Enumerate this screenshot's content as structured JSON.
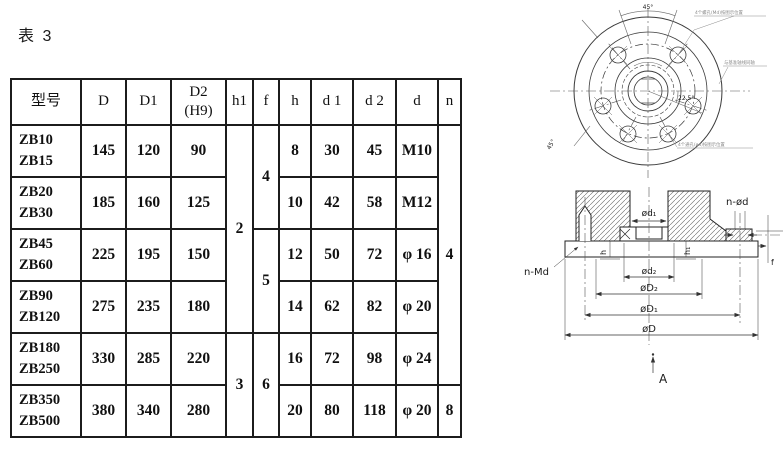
{
  "title": "表 3",
  "table": {
    "headers": {
      "model": "型号",
      "D": "D",
      "D1": "D1",
      "D2": "D2\n(H9)",
      "h1": "h1",
      "f": "f",
      "h": "h",
      "d1": "d 1",
      "d2": "d 2",
      "d": "d",
      "n": "n"
    },
    "rows": [
      {
        "model": "ZB10\nZB15",
        "D": "145",
        "D1": "120",
        "D2": "90",
        "h": "8",
        "d1": "30",
        "d2": "45",
        "d": "M10"
      },
      {
        "model": "ZB20\nZB30",
        "D": "185",
        "D1": "160",
        "D2": "125",
        "h": "10",
        "d1": "42",
        "d2": "58",
        "d": "M12"
      },
      {
        "model": "ZB45\nZB60",
        "D": "225",
        "D1": "195",
        "D2": "150",
        "h": "12",
        "d1": "50",
        "d2": "72",
        "d": "φ 16"
      },
      {
        "model": "ZB90\nZB120",
        "D": "275",
        "D1": "235",
        "D2": "180",
        "h": "14",
        "d1": "62",
        "d2": "82",
        "d": "φ 20"
      },
      {
        "model": "ZB180\nZB250",
        "D": "330",
        "D1": "285",
        "D2": "220",
        "h": "16",
        "d1": "72",
        "d2": "98",
        "d": "φ 24"
      },
      {
        "model": "ZB350\nZB500",
        "D": "380",
        "D1": "340",
        "D2": "280",
        "h": "20",
        "d1": "80",
        "d2": "118",
        "d": "φ 20"
      }
    ],
    "merged": {
      "h1_a": "2",
      "h1_b": "3",
      "f_a": "4",
      "f_b": "5",
      "f_c": "6",
      "n_a": "4",
      "n_b": "8"
    }
  },
  "front_view": {
    "angle_top": "45°",
    "angle_right": "22.5°",
    "angle_left": "45°",
    "note_top": "4个螺孔(Md)按图示位置",
    "note_right": "与基准轴线同轴",
    "note_bottom": "4个通孔(ød)按图示位置"
  },
  "section_view": {
    "n_md": "n-Md",
    "n_od": "n-ød",
    "d1": "ød₁",
    "d2": "ød₂",
    "D2": "øD₂",
    "D1": "øD₁",
    "D": "øD",
    "h": "h",
    "h1": "h₁",
    "f": "f",
    "datum": "A"
  }
}
